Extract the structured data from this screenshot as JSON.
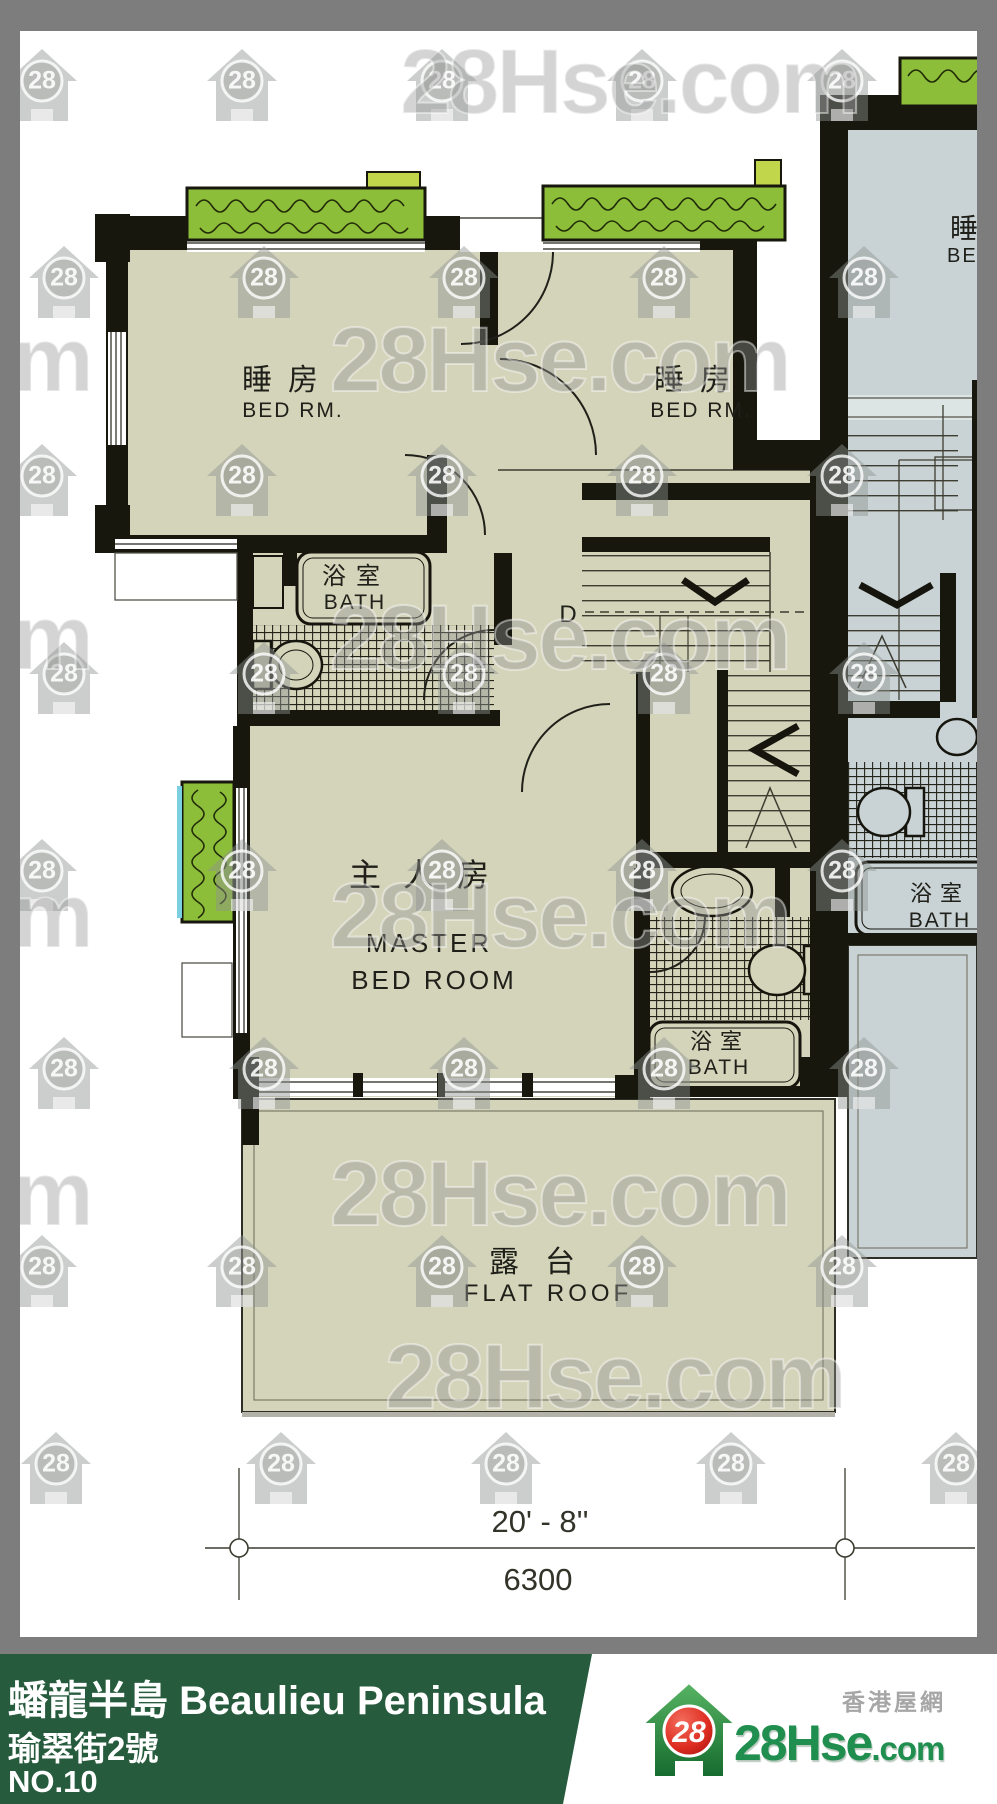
{
  "watermark": {
    "badge": "28",
    "text": "28Hse.com"
  },
  "plan": {
    "rooms": {
      "bedroom1": {
        "zh": "睡房",
        "en": "BED RM."
      },
      "bedroom2": {
        "zh": "睡房",
        "en": "BED RM."
      },
      "bath1": {
        "zh": "浴室",
        "en": "BATH"
      },
      "master": {
        "zh": "主人房",
        "en1": "MASTER",
        "en2": "BED ROOM"
      },
      "bath2": {
        "zh": "浴室",
        "en": "BATH"
      },
      "flat_roof": {
        "zh": "露台",
        "en": "FLAT ROOF"
      },
      "adj_bedroom": {
        "zh": "睡房",
        "en": "BED RM."
      },
      "adj_bath": {
        "zh": "浴室",
        "en": "BATH"
      }
    },
    "stairs": {
      "door_label": "D"
    },
    "dimension": {
      "imperial": "20' - 8''",
      "metric": "6300"
    }
  },
  "footer": {
    "title": "蟠龍半島 Beaulieu Peninsula",
    "address": "瑜翠街2號",
    "unit": "NO.10",
    "logo": {
      "badge": "28",
      "brand": "28Hse",
      "suffix": ".com",
      "tagline": "香港屋網"
    },
    "colors": {
      "bar": "#275b3d",
      "brand": "#1f8e4e"
    }
  }
}
